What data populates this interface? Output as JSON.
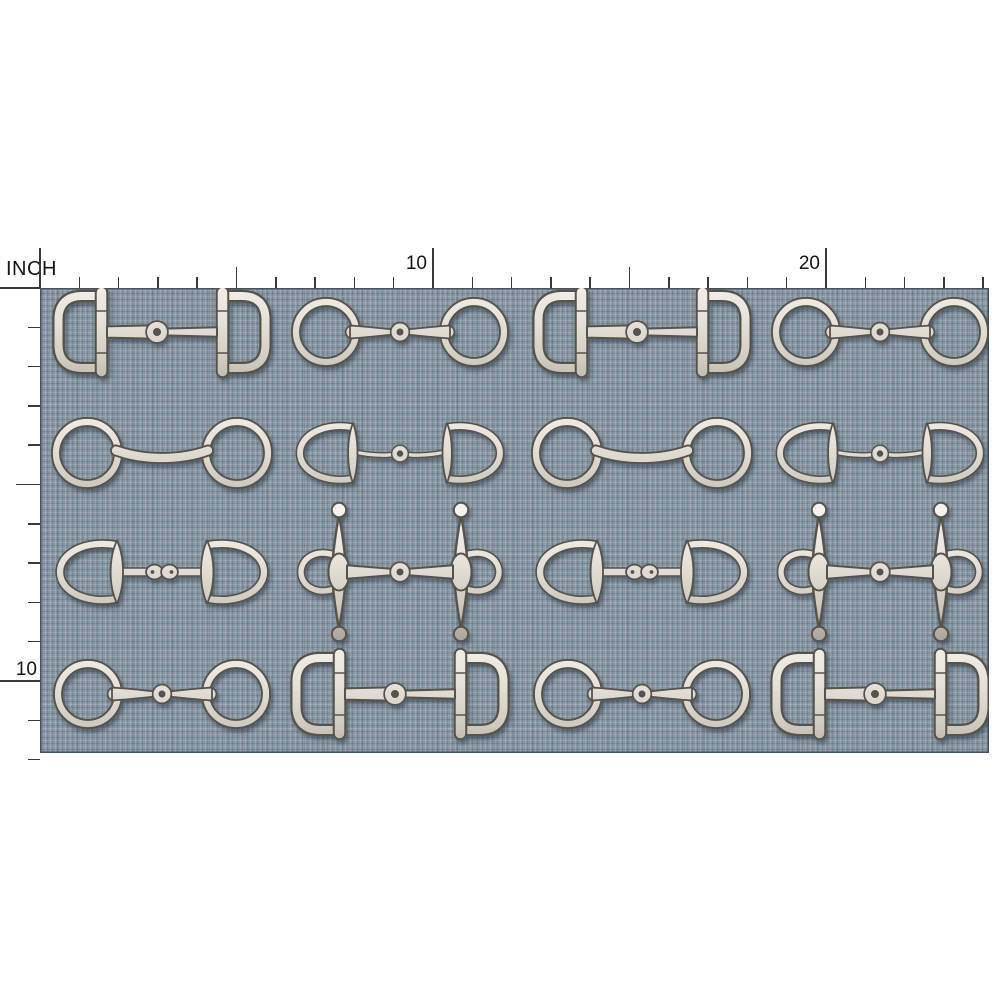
{
  "ruler": {
    "unit_label": "INCH",
    "pixels_per_inch": 39.3,
    "horizontal": {
      "origin_x": 40,
      "base_y": 288,
      "inches": 24,
      "labels": [
        {
          "inch": 10,
          "text": "10"
        },
        {
          "inch": 20,
          "text": "20"
        }
      ]
    },
    "vertical": {
      "origin_y": 288,
      "base_x": 40,
      "inches": 12,
      "labels": [
        {
          "inch": 10,
          "text": "10"
        }
      ]
    }
  },
  "fabric": {
    "visible_width_inches": 24,
    "visible_height_inches": 12,
    "texture": "linen-crosshatch",
    "left_px": 40,
    "top_px": 288,
    "width_px": 949,
    "height_px": 465
  },
  "pattern": {
    "motif_theme": "horse-snaffle-bits",
    "col_centers_px": [
      162,
      400,
      642,
      880
    ],
    "row_centers_px": [
      332,
      453,
      572,
      694
    ],
    "rows": [
      [
        "d-ring-snaffle",
        "loose-ring-snaffle",
        "d-ring-snaffle",
        "loose-ring-snaffle"
      ],
      [
        "loose-ring-mullen",
        "eggbutt-snaffle",
        "loose-ring-mullen",
        "eggbutt-snaffle"
      ],
      [
        "eggbutt-double-joint",
        "full-cheek-snaffle",
        "eggbutt-double-joint",
        "full-cheek-snaffle"
      ],
      [
        "loose-ring-snaffle",
        "d-ring-snaffle",
        "loose-ring-snaffle",
        "d-ring-snaffle"
      ]
    ]
  },
  "colors": {
    "page_bg": "#ffffff",
    "fabric_base": "#8796a3",
    "fabric_edge": "#46535e",
    "metal_light": "#f8f6f1",
    "metal_mid": "#e6e2d9",
    "metal_shade": "#a9a299",
    "metal_outline": "#57524b",
    "ruler_line": "#3a3a3a",
    "ruler_text": "#141414",
    "shadow": "#273642"
  }
}
